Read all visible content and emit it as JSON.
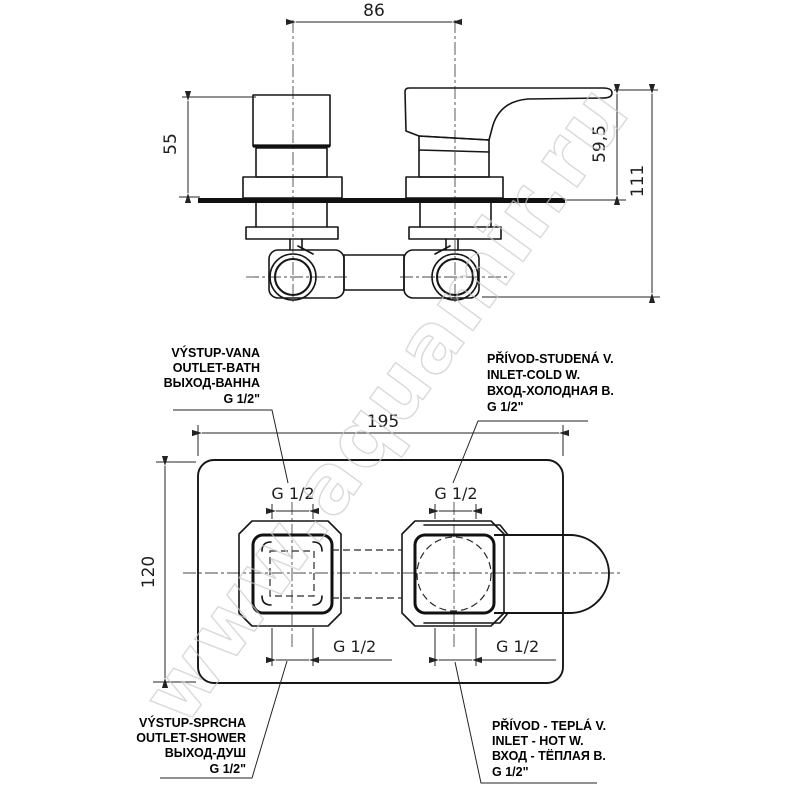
{
  "watermark": "www.aquamir.ru",
  "front_view": {
    "dims": {
      "handle_spacing": "86",
      "knob_height": "55",
      "lever_height": "59,5",
      "total_height": "111"
    }
  },
  "plan_view": {
    "dims": {
      "plate_width": "195",
      "plate_height": "120"
    },
    "threads": {
      "top_left": "G 1/2",
      "top_right": "G 1/2",
      "bottom_left": "G 1/2",
      "bottom_right": "G 1/2"
    }
  },
  "port_labels": {
    "outlet_bath": {
      "lines": [
        "VÝSTUP-VANA",
        "OUTLET-BATH",
        "ВЫХОД-ВАННА",
        "G 1/2\""
      ]
    },
    "inlet_cold": {
      "lines": [
        "PŘÍVOD-STUDENÁ V.",
        "INLET-COLD W.",
        "ВХОД-ХОЛОДНАЯ В.",
        "G 1/2\""
      ]
    },
    "outlet_shower": {
      "lines": [
        "VÝSTUP-SPRCHA",
        "OUTLET-SHOWER",
        "ВЫХОД-ДУШ",
        "G 1/2\""
      ]
    },
    "inlet_hot": {
      "lines": [
        "PŘÍVOD - TEPLÁ V.",
        "INLET - HOT W.",
        "ВХОД - ТЁПЛАЯ В.",
        "G 1/2\""
      ]
    }
  }
}
